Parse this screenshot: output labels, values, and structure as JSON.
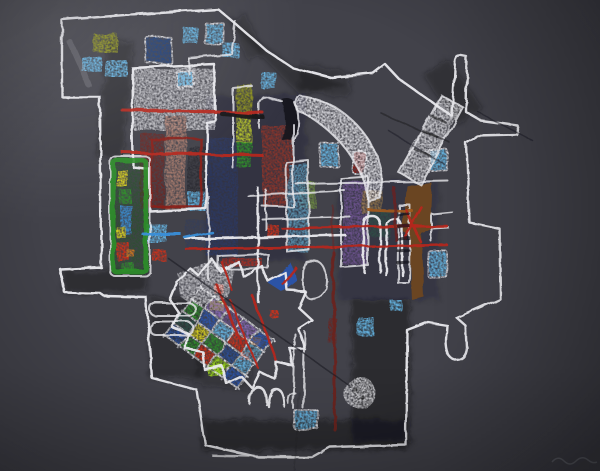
{
  "artwork": {
    "palette": {
      "background": "#42424a",
      "paper_light": "#56565e",
      "chalk": "#eaeaee",
      "charcoal": "#15151a",
      "pencil": "#1d1d24",
      "faint_mark": "#9aa0a8",
      "light_blue": "#66b9e8",
      "pale_blue": "#8ecdf0",
      "dark_blue": "#1e3f7a",
      "navy": "#2a3a66",
      "azure": "#3a8fd8",
      "teal_blue": "#5f9fc0",
      "teal_dark": "#2e4f46",
      "olive": "#8f931d",
      "yellow_green": "#b6c42a",
      "moss": "#6f8f3f",
      "green": "#2f8f2a",
      "dark_green": "#1e5a1e",
      "lime": "#9ad818",
      "brick": "#8b352a",
      "dark_red": "#8b1f1a",
      "crimson": "#b5281c",
      "red": "#d23018",
      "maroon": "#6b2420",
      "salmon": "#b07f6e",
      "gray_stripe": "#2a2a31",
      "purple": "#6e538f",
      "dark_purple": "#55356e",
      "violet": "#8a6ab8",
      "brown": "#6b4522",
      "tan": "#9a7a4a",
      "yellow": "#ddd41e",
      "orange": "#d97b1e",
      "orange_brown": "#a05a20",
      "blue": "#2a55b0",
      "blue_deep": "#2a4f9a"
    },
    "blue_squares": [
      {
        "x": 183,
        "y": 27,
        "w": 15,
        "h": 17
      },
      {
        "x": 205,
        "y": 23,
        "w": 19,
        "h": 21,
        "outline": true
      },
      {
        "x": 223,
        "y": 43,
        "w": 16,
        "h": 15
      },
      {
        "x": 82,
        "y": 57,
        "w": 20,
        "h": 15
      },
      {
        "x": 105,
        "y": 60,
        "w": 22,
        "h": 17
      },
      {
        "x": 177,
        "y": 72,
        "w": 17,
        "h": 15,
        "outline": true
      },
      {
        "x": 261,
        "y": 72,
        "w": 15,
        "h": 17
      },
      {
        "x": 320,
        "y": 143,
        "w": 19,
        "h": 24,
        "outline": true
      },
      {
        "x": 430,
        "y": 150,
        "w": 18,
        "h": 21,
        "outline": true
      },
      {
        "x": 188,
        "y": 192,
        "w": 18,
        "h": 19
      },
      {
        "x": 146,
        "y": 224,
        "w": 21,
        "h": 18
      },
      {
        "x": 428,
        "y": 251,
        "w": 19,
        "h": 26,
        "outline": true
      },
      {
        "x": 358,
        "y": 317,
        "w": 16,
        "h": 19
      },
      {
        "x": 294,
        "y": 410,
        "w": 24,
        "h": 19,
        "outline": true
      },
      {
        "x": 390,
        "y": 300,
        "w": 12,
        "h": 11
      }
    ],
    "color_blocks": [
      {
        "name": "olive-square",
        "x": 94,
        "y": 34,
        "w": 24,
        "h": 19,
        "fill": "olive"
      },
      {
        "name": "darkblue-square",
        "x": 146,
        "y": 37,
        "w": 25,
        "h": 26,
        "fill": "dark_blue",
        "outline": true,
        "rot": -2
      },
      {
        "name": "white-chalk-block",
        "x": 133,
        "y": 68,
        "w": 82,
        "h": 62,
        "fill": "chalk",
        "op": 0.72
      },
      {
        "name": "maroon-stripe",
        "x": 140,
        "y": 133,
        "w": 24,
        "h": 76,
        "fill": "maroon",
        "op": 0.9
      },
      {
        "name": "salmon-stripe",
        "x": 165,
        "y": 116,
        "w": 21,
        "h": 94,
        "fill": "salmon",
        "op": 0.85
      },
      {
        "name": "gray-stripe",
        "x": 188,
        "y": 147,
        "w": 25,
        "h": 62,
        "fill": "gray_stripe",
        "op": 0.9
      },
      {
        "name": "navy-block",
        "x": 206,
        "y": 138,
        "w": 32,
        "h": 118,
        "fill": "navy",
        "op": 0.8
      },
      {
        "name": "navy-patch",
        "x": 186,
        "y": 220,
        "w": 26,
        "h": 28,
        "fill": "navy",
        "op": 0.45
      },
      {
        "name": "bar-olive",
        "x": 236,
        "y": 84,
        "w": 16,
        "h": 30,
        "fill": "olive"
      },
      {
        "name": "bar-yellow-green",
        "x": 236,
        "y": 113,
        "w": 16,
        "h": 30,
        "fill": "yellow_green"
      },
      {
        "name": "bar-green",
        "x": 237,
        "y": 142,
        "w": 15,
        "h": 26,
        "fill": "green"
      },
      {
        "name": "brick-center",
        "x": 262,
        "y": 126,
        "w": 31,
        "h": 80,
        "fill": "brick",
        "op": 0.95
      },
      {
        "name": "moss-patch",
        "x": 299,
        "y": 182,
        "w": 17,
        "h": 26,
        "fill": "moss",
        "op": 0.9
      },
      {
        "name": "teal-column",
        "x": 288,
        "y": 164,
        "w": 20,
        "h": 88,
        "fill": "teal_blue",
        "op": 0.85
      },
      {
        "name": "purple-block",
        "x": 343,
        "y": 181,
        "w": 25,
        "h": 84,
        "fill": "purple",
        "op": 0.95
      },
      {
        "name": "tan-patch",
        "x": 362,
        "y": 190,
        "w": 20,
        "h": 24,
        "fill": "tan",
        "op": 0.85
      },
      {
        "name": "teal-dark-block",
        "x": 369,
        "y": 212,
        "w": 21,
        "h": 25,
        "fill": "teal_dark",
        "op": 0.9
      },
      {
        "name": "red-pill",
        "x": 353,
        "y": 151,
        "w": 13,
        "h": 24,
        "fill": "dark_red",
        "rx": 4,
        "outline": true
      },
      {
        "name": "red-square-left",
        "x": 152,
        "y": 249,
        "w": 13,
        "h": 12,
        "fill": "red"
      },
      {
        "name": "red-square-center",
        "x": 267,
        "y": 224,
        "w": 11,
        "h": 13,
        "fill": "red"
      },
      {
        "name": "greenbar-bg",
        "x": 113,
        "y": 160,
        "w": 33,
        "h": 112,
        "fill": "dark_green",
        "op": 0.5
      },
      {
        "name": "greenbar-yellow",
        "x": 117,
        "y": 170,
        "w": 11,
        "h": 17,
        "fill": "yellow"
      },
      {
        "name": "greenbar-green",
        "x": 119,
        "y": 189,
        "w": 12,
        "h": 14,
        "fill": "green"
      },
      {
        "name": "greenbar-blue",
        "x": 120,
        "y": 205,
        "w": 12,
        "h": 30,
        "fill": "azure"
      },
      {
        "name": "greenbar-yellow2",
        "x": 116,
        "y": 227,
        "w": 10,
        "h": 11,
        "fill": "yellow"
      },
      {
        "name": "greenbar-red",
        "x": 117,
        "y": 243,
        "w": 13,
        "h": 18,
        "fill": "red"
      },
      {
        "name": "greenbar-orange",
        "x": 127,
        "y": 250,
        "w": 8,
        "h": 8,
        "fill": "orange"
      },
      {
        "name": "greenbar-green2",
        "x": 121,
        "y": 263,
        "w": 14,
        "h": 9,
        "fill": "green"
      },
      {
        "name": "red-bar",
        "x": 222,
        "y": 258,
        "w": 40,
        "h": 8,
        "fill": "crimson",
        "op": 0.85
      },
      {
        "name": "maroon-thick",
        "x": 329,
        "y": 318,
        "w": 8,
        "h": 26,
        "fill": "maroon",
        "op": 0.9
      },
      {
        "name": "fan-dot-yellow",
        "x": 211,
        "y": 301,
        "w": 13,
        "h": 11,
        "fill": "yellow"
      },
      {
        "name": "fan-dot-red1",
        "x": 214,
        "y": 284,
        "w": 9,
        "h": 9,
        "fill": "red"
      },
      {
        "name": "fan-dot-red2",
        "x": 240,
        "y": 351,
        "w": 9,
        "h": 9,
        "fill": "red"
      },
      {
        "name": "fan-dot-red3",
        "x": 270,
        "y": 310,
        "w": 8,
        "h": 8,
        "fill": "red"
      },
      {
        "name": "fan-dot-orange",
        "x": 251,
        "y": 337,
        "w": 10,
        "h": 9,
        "fill": "orange"
      },
      {
        "name": "fan-dot-lime",
        "x": 208,
        "y": 364,
        "w": 18,
        "h": 12,
        "fill": "lime"
      }
    ],
    "accent_lines": [
      {
        "name": "red-h1",
        "x1": 122,
        "y1": 110,
        "x2": 263,
        "y2": 113,
        "stroke": "crimson",
        "w": 3
      },
      {
        "name": "red-h2",
        "x1": 122,
        "y1": 152,
        "x2": 263,
        "y2": 156,
        "stroke": "crimson",
        "w": 3
      },
      {
        "name": "red-h3",
        "x1": 282,
        "y1": 228,
        "x2": 447,
        "y2": 226,
        "stroke": "crimson",
        "w": 2.5
      },
      {
        "name": "red-h4",
        "x1": 186,
        "y1": 249,
        "x2": 447,
        "y2": 245,
        "stroke": "crimson",
        "w": 2.5
      },
      {
        "name": "black-h",
        "x1": 222,
        "y1": 114,
        "x2": 263,
        "y2": 117,
        "stroke": "charcoal",
        "w": 4
      },
      {
        "name": "blue-h",
        "x1": 143,
        "y1": 234,
        "x2": 180,
        "y2": 234,
        "stroke": "azure",
        "w": 3
      },
      {
        "name": "blue-diag",
        "x1": 185,
        "y1": 238,
        "x2": 212,
        "y2": 232,
        "stroke": "azure",
        "w": 2.5
      },
      {
        "name": "maroon-v",
        "x1": 333,
        "y1": 252,
        "x2": 335,
        "y2": 430,
        "stroke": "maroon",
        "w": 3
      },
      {
        "name": "maroon-v-upper",
        "x1": 332,
        "y1": 205,
        "x2": 333,
        "y2": 252,
        "stroke": "maroon",
        "w": 2,
        "op": 0.5
      },
      {
        "name": "orange-h",
        "x1": 368,
        "y1": 209,
        "x2": 412,
        "y2": 211,
        "stroke": "orange_brown",
        "w": 3
      },
      {
        "name": "darkred-v",
        "x1": 394,
        "y1": 188,
        "x2": 396,
        "y2": 240,
        "stroke": "maroon",
        "w": 3,
        "op": 0.8
      },
      {
        "name": "red-x1",
        "x1": 405,
        "y1": 238,
        "x2": 422,
        "y2": 208,
        "stroke": "crimson",
        "w": 2.5
      },
      {
        "name": "red-x2",
        "x1": 406,
        "y1": 210,
        "x2": 421,
        "y2": 242,
        "stroke": "crimson",
        "w": 2.5
      },
      {
        "name": "red-diag1",
        "x1": 216,
        "y1": 284,
        "x2": 242,
        "y2": 344,
        "stroke": "crimson",
        "w": 2.5
      },
      {
        "name": "red-diag2",
        "x1": 252,
        "y1": 295,
        "x2": 276,
        "y2": 360,
        "stroke": "crimson",
        "w": 2.5
      },
      {
        "name": "red-diag3",
        "x1": 230,
        "y1": 300,
        "x2": 258,
        "y2": 368,
        "stroke": "crimson",
        "w": 2
      },
      {
        "name": "red-diag4",
        "x1": 283,
        "y1": 284,
        "x2": 296,
        "y2": 268,
        "stroke": "crimson",
        "w": 2.5
      },
      {
        "name": "red-diag5",
        "x1": 222,
        "y1": 262,
        "x2": 232,
        "y2": 290,
        "stroke": "crimson",
        "w": 2
      },
      {
        "name": "crease-diag",
        "x1": 168,
        "y1": 258,
        "x2": 350,
        "y2": 386,
        "stroke": "pencil",
        "w": 1.5,
        "op": 0.65
      },
      {
        "name": "pencil-1",
        "x1": 382,
        "y1": 114,
        "x2": 450,
        "y2": 143,
        "stroke": "pencil",
        "w": 1.5,
        "op": 0.55
      },
      {
        "name": "pencil-2",
        "x1": 388,
        "y1": 130,
        "x2": 445,
        "y2": 165,
        "stroke": "pencil",
        "w": 1.5,
        "op": 0.5
      },
      {
        "name": "pencil-3",
        "x1": 478,
        "y1": 112,
        "x2": 533,
        "y2": 141,
        "stroke": "pencil",
        "w": 1.5,
        "op": 0.5
      },
      {
        "name": "pencil-4",
        "x1": 299,
        "y1": 392,
        "x2": 294,
        "y2": 470,
        "stroke": "pencil",
        "w": 1.5,
        "op": 0.22
      },
      {
        "name": "band-hatch1",
        "x1": 430,
        "y1": 115,
        "x2": 445,
        "y2": 122,
        "stroke": "charcoal",
        "w": 2.5,
        "op": 0.55
      },
      {
        "name": "band-hatch2",
        "x1": 422,
        "y1": 130,
        "x2": 438,
        "y2": 138,
        "stroke": "charcoal",
        "w": 2.5,
        "op": 0.55
      },
      {
        "name": "band-hatch3",
        "x1": 414,
        "y1": 148,
        "x2": 430,
        "y2": 156,
        "stroke": "charcoal",
        "w": 2.5,
        "op": 0.5
      },
      {
        "name": "ladder-rung1",
        "x1": 399,
        "y1": 215,
        "x2": 409,
        "y2": 214,
        "stroke": "charcoal",
        "w": 3,
        "op": 0.7
      },
      {
        "name": "ladder-rung2",
        "x1": 399,
        "y1": 227,
        "x2": 409,
        "y2": 226,
        "stroke": "charcoal",
        "w": 3,
        "op": 0.7
      },
      {
        "name": "ladder-rung3",
        "x1": 399,
        "y1": 239,
        "x2": 409,
        "y2": 238,
        "stroke": "charcoal",
        "w": 3,
        "op": 0.7
      },
      {
        "name": "ladder-rung4",
        "x1": 398,
        "y1": 251,
        "x2": 408,
        "y2": 250,
        "stroke": "charcoal",
        "w": 3,
        "op": 0.7
      },
      {
        "name": "ladder-rung5",
        "x1": 398,
        "y1": 263,
        "x2": 408,
        "y2": 262,
        "stroke": "charcoal",
        "w": 3,
        "op": 0.7
      }
    ],
    "fan": {
      "tx": 200,
      "ty": 288,
      "angle": 36,
      "cell_w": 18,
      "cell_h": 15,
      "rows": [
        [
          "",
          "violet",
          "purple",
          "violet",
          "blue"
        ],
        [
          "green",
          "blue",
          "light_blue",
          "red",
          "teal_blue"
        ],
        [
          "teal_dark",
          "yellow",
          "green",
          "blue_deep",
          "light_blue"
        ],
        [
          "blue_deep",
          "green",
          "red",
          "lime",
          "blue"
        ]
      ]
    }
  }
}
